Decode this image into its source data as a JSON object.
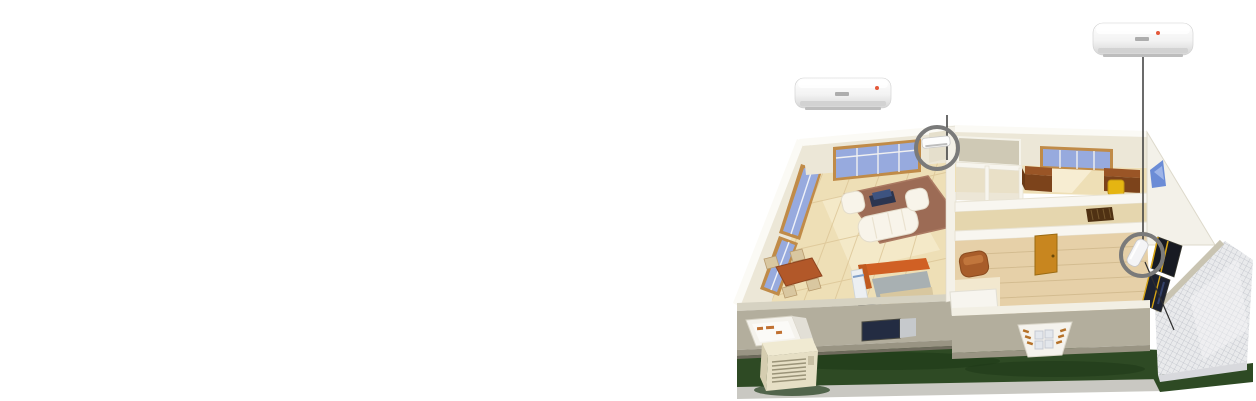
{
  "illustration": {
    "type": "isometric-cutaway-house-with-split-air-conditioners",
    "ac_units": [
      {
        "id": "living-room-unit",
        "enlarged_view": "top-left",
        "callout": "gray-circle-with-vertical-leader-line",
        "indicator": "red-status-dot"
      },
      {
        "id": "bedroom-unit",
        "enlarged_view": "top-right",
        "callout": "gray-circle-with-vertical-leader-line",
        "indicator": "red-status-dot"
      }
    ],
    "rooms": [
      "living-room",
      "dining-area",
      "kitchen",
      "office",
      "hallway",
      "bedroom"
    ],
    "exterior_features": [
      "lawn",
      "sidewalk-strip",
      "tiled-patio",
      "outdoor-condenser-unit",
      "open-casement-window",
      "bay-window",
      "dark-framed-windows",
      "blue-wall-decal"
    ]
  },
  "colors": {
    "background": "#ffffff",
    "grass": "#2e4a24",
    "grass_shadow": "#1f3a19",
    "sidewalk": "#c9c8c2",
    "patio_edge": "#d8d9dd",
    "wall_top": "#fbfaf5",
    "wall_inner": "#ece7d7",
    "wall_front_gray": "#b3ae9d",
    "wall_front_band": "#999483",
    "wall_front_strip": "#d6d2c2",
    "wall_exterior_light": "#f3f1e9",
    "floor_wood": "#eedfb6",
    "floor_wood_dark": "#e6d0a8",
    "hall_floor": "#e5d6ae",
    "hall_top_tan": "#cfc9b5",
    "window_glass": "#97aade",
    "window_frame": "#c08b48",
    "rug": "#9c6b55",
    "sofa_white": "#f8f4ea",
    "tv_stand": "#2b3550",
    "tv_screen": "#3d5380",
    "dining_table": "#b25829",
    "chair_beige": "#d9c7a0",
    "kitchen_counter": "#d06024",
    "kitchen_island": "#a8b0b2",
    "kitchen_cabinet": "#eceff2",
    "kitchen_back_counter": "#d8c79f",
    "laptop_dark": "#202839",
    "door_orange": "#c8861f",
    "desk_top": "#9a5526",
    "desk_front": "#7c431b",
    "chair_yellow": "#e5b512",
    "armchair_brown": "#a85d2a",
    "armchair_back": "#c1763c",
    "bed_white": "#f7f5ef",
    "doormat": "#4f3113",
    "dark_window": "#171a22",
    "dark_window2": "#1c2130",
    "dark_window_frame": "#d6a415",
    "decal_blue": "#6b8cd6",
    "decal_blue_light": "#9db4e8",
    "outdoor_unit_top": "#f0ead2",
    "outdoor_unit_front": "#e6dfc5",
    "outdoor_unit_side": "#d5cdb0",
    "window_opening_dark": "#232c42",
    "casement_white": "#f5f3ed",
    "callout_circle": "#7a7a7a",
    "leader_line": "#3a3a3a",
    "ac_flap": "#d2d2d2",
    "ac_vent": "#bdbdbd",
    "ac_logo": "#adadad",
    "ac_indicator_red": "#e4593a",
    "small_ac_white": "#fdfdfd"
  }
}
